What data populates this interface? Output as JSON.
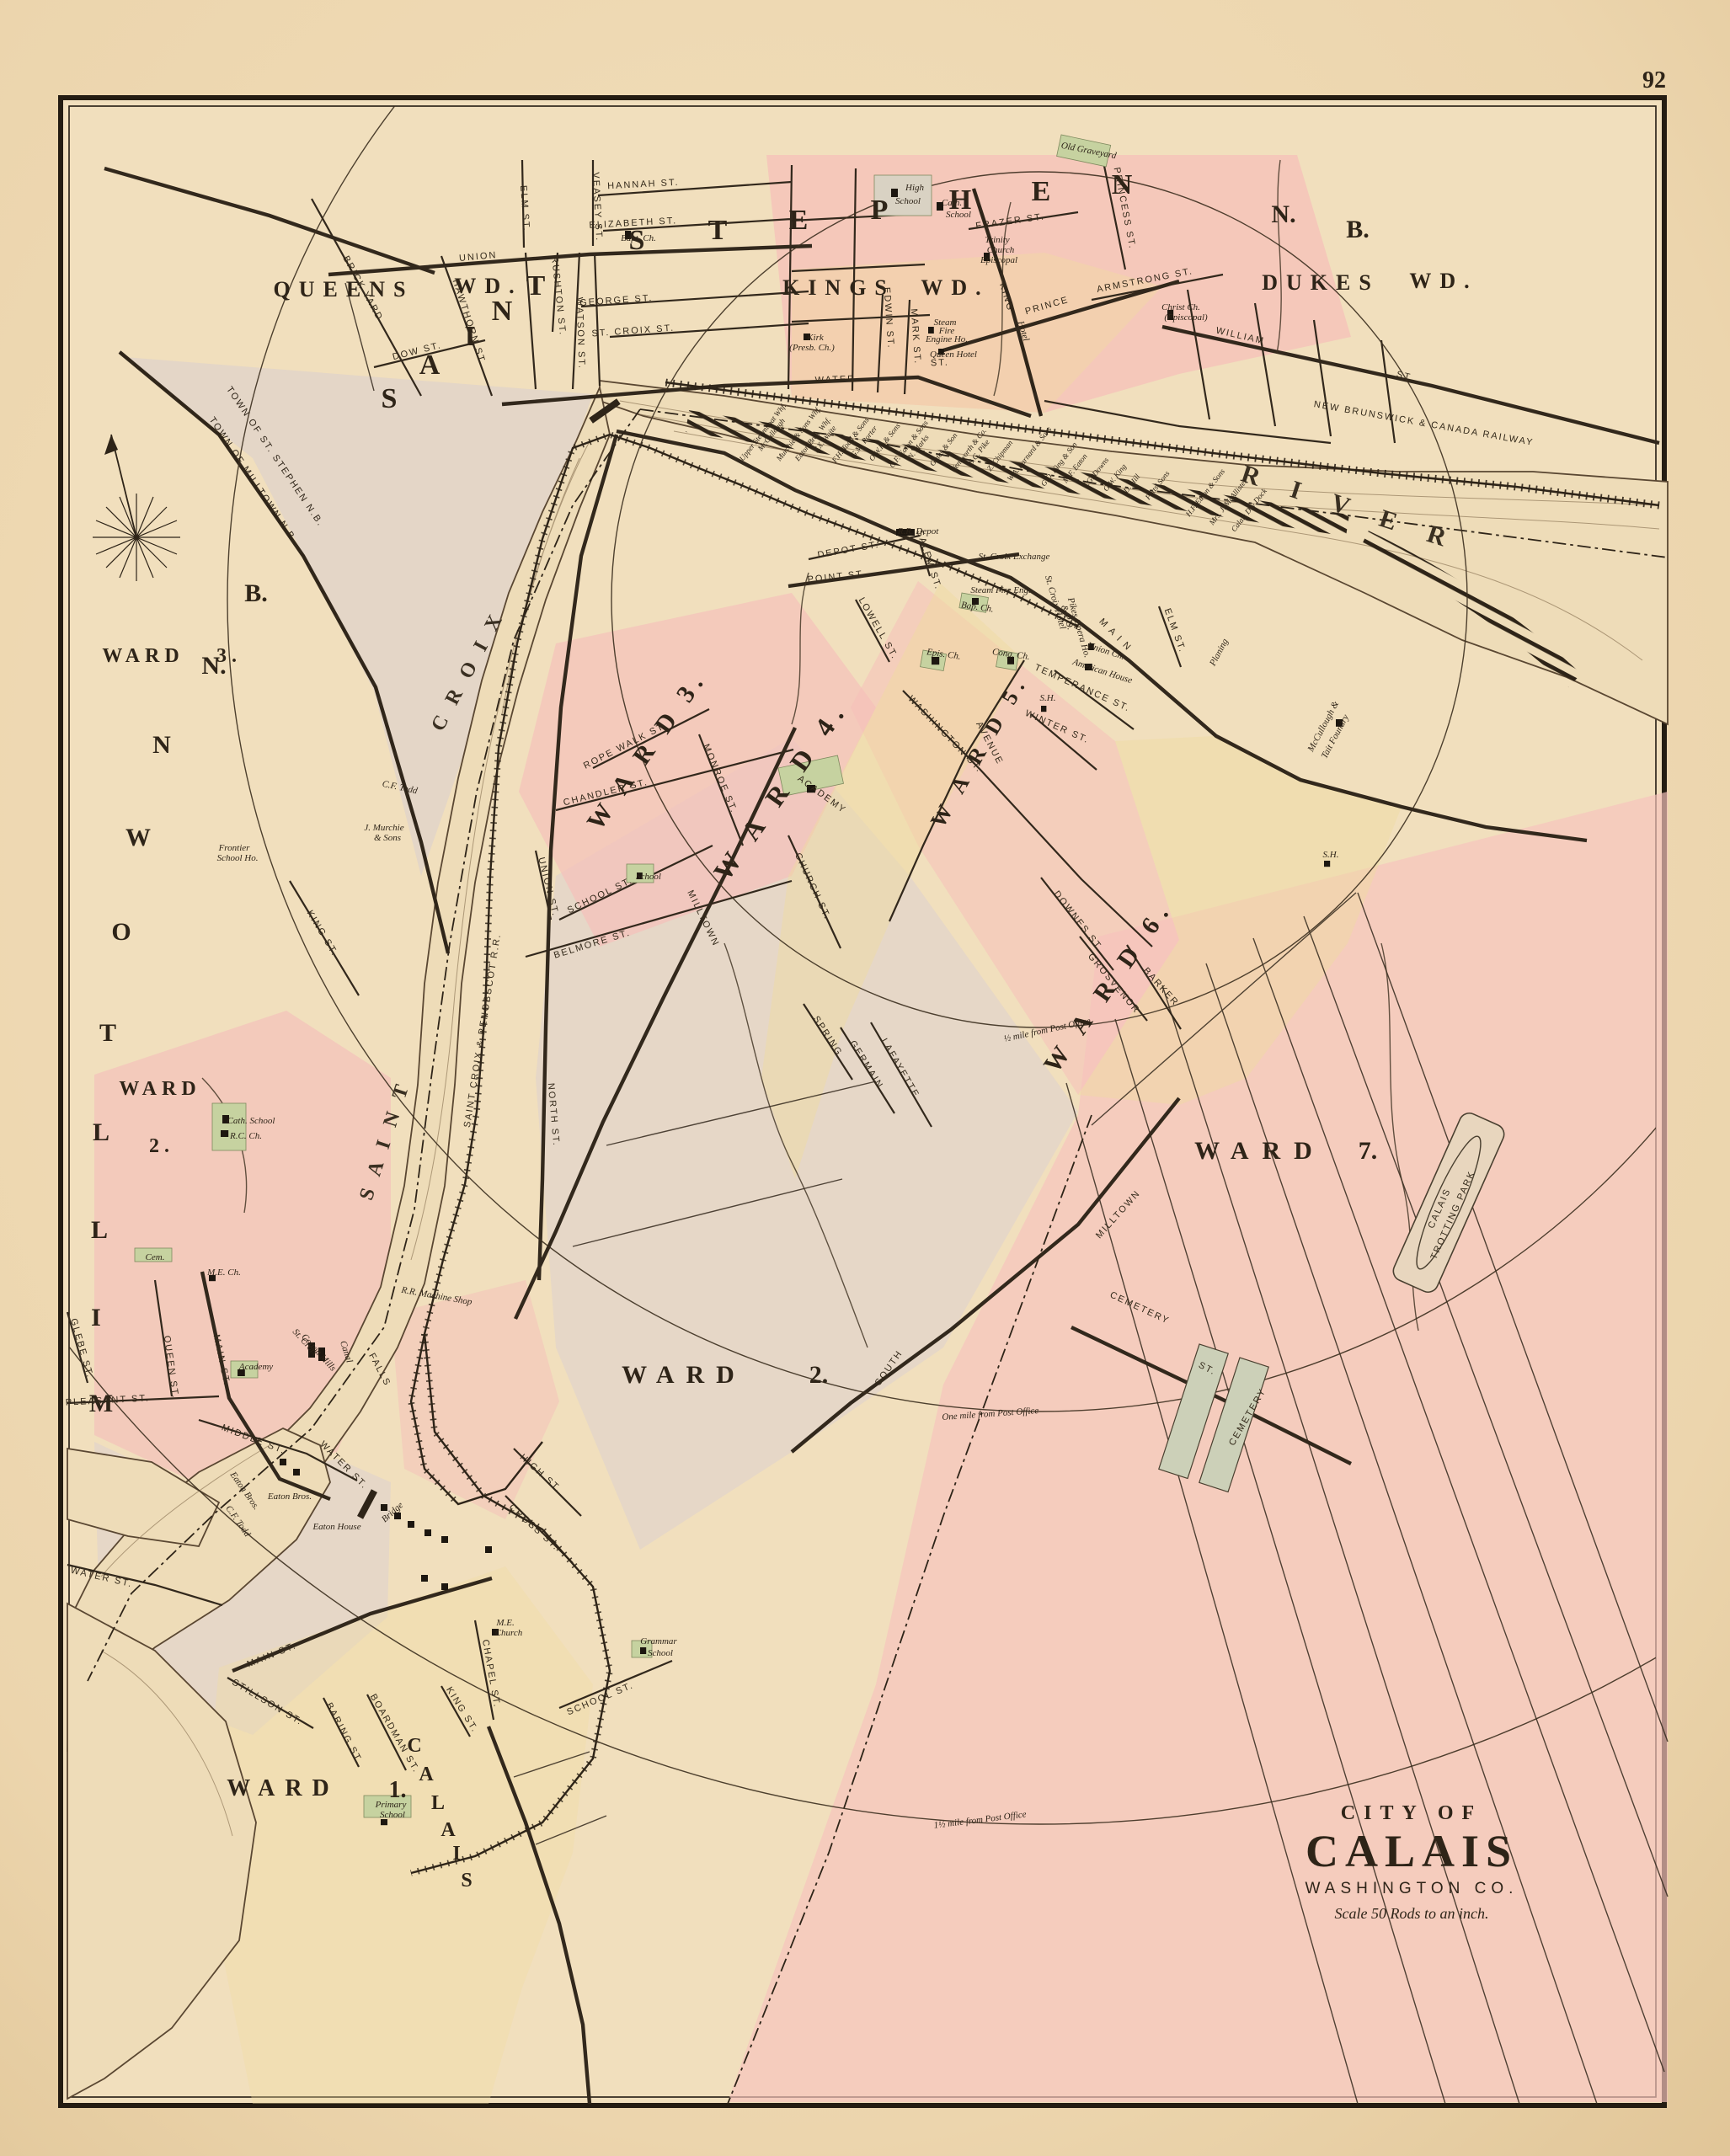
{
  "page_number": "92",
  "title_block": {
    "line1": "CITY OF",
    "line2": "CALAIS",
    "line3": "WASHINGTON CO.",
    "line4": "Scale 50 Rods to an inch."
  },
  "boundary_labels": {
    "st_stephen_side": "TOWN OF ST. STEPHEN N.B.",
    "milltown_side": "TOWN OF MILLTOWN N.B."
  },
  "distance_arcs": {
    "half_mile": "½ mile from Post Office",
    "one_mile": "One mile from Post Office",
    "one_half_mile": "1½ mile from Post Office"
  },
  "railways": {
    "nb_canada": "NEW BRUNSWICK & CANADA RAILWAY",
    "sc_penobscot": "SAINT CROIX & PENOBSCOT R.R."
  },
  "river": {
    "saint": "S A I N T",
    "croix": "C R O I X",
    "river": "R I V E R",
    "falls": "FALLS",
    "canal": "Canal",
    "bridge": "Bridge"
  },
  "nb_wards": {
    "queens": "QUEENS",
    "queens_wd": "WD.",
    "kings": "KINGS",
    "kings_wd": "WD.",
    "dukes": "DUKES",
    "dukes_wd": "WD.",
    "nb_n": "N.",
    "nb_b": "B.",
    "ward3": "WARD",
    "ward3_num": "3.",
    "ward2": "WARD",
    "ward2_num": "2."
  },
  "big_letters": {
    "saint": [
      "S",
      "A",
      "I",
      "N",
      "T"
    ],
    "stephen": [
      "S",
      "T",
      "E",
      "P",
      "H",
      "E",
      "N"
    ],
    "milltown_vertical": [
      "B.",
      "N.",
      "N",
      "W",
      "O",
      "T",
      "L",
      "L",
      "I",
      "M"
    ],
    "calais_vertical": [
      "C",
      "A",
      "L",
      "A",
      "I",
      "S"
    ]
  },
  "calais_wards": {
    "ward1": "WARD",
    "ward1_num": "1.",
    "ward2": "WARD",
    "ward2_num": "2.",
    "ward3": "W A R D  3.",
    "ward4": "W A R D  4.",
    "ward5": "W A R D  5.",
    "ward6": "W A R D  6.",
    "ward7": "WARD",
    "ward7_num": "7."
  },
  "st_stephen_streets": {
    "union": "UNION",
    "hannah": "HANNAH ST.",
    "elizabeth": "ELIZABETH ST.",
    "george": "GEORGE ST.",
    "st_croix": "ST. CROIX ST.",
    "elm": "ELM ST.",
    "veasey": "VEASEY ST.",
    "watson": "WATSON ST.",
    "rushton": "RUSHTON ST.",
    "hawthorn": "HAWTHORN ST.",
    "brick_yard": "BRICK YARD",
    "dow": "DOW ST.",
    "water": "WATER",
    "water_st": "ST.",
    "king": "KING",
    "frazer": "FRAZER ST.",
    "prince": "PRINCE",
    "william": "WILLIAM",
    "william_st": "ST.",
    "princess": "PRINCESS ST.",
    "armstrong": "ARMSTRONG ST.",
    "edwin": "EDWIN ST.",
    "mark": "MARK ST."
  },
  "st_stephen_places": {
    "bapt_ch": "Bapt. Ch.",
    "high_school_1": "High",
    "high_school_2": "School",
    "cath_school_1": "Cath.",
    "cath_school_2": "School",
    "trinity_1": "Trinity",
    "trinity_2": "Church",
    "trinity_3": "Episcopal",
    "old_graveyard": "Old Graveyard",
    "christ_ch_1": "Christ Ch.",
    "christ_ch_2": "(Episcopal)",
    "kirk_1": "Kirk",
    "kirk_2": "(Presb. Ch.)",
    "steam_fire_1": "Steam",
    "steam_fire_2": "Fire",
    "steam_fire_3": "Engine Ho.",
    "queen_hotel": "Queen Hotel",
    "hotel": "Hotel"
  },
  "calais_streets": {
    "main": "M A I N",
    "north": "NORTH ST.",
    "point": "POINT ST.",
    "depot": "DEPOT ST.",
    "salem": "SALEM ST.",
    "lowell": "LOWELL ST.",
    "monroe": "MONROE ST.",
    "washington": "WASHINGTON ST.",
    "avenue": "AVENUE",
    "temperance": "TEMPERANCE ST.",
    "winter": "WINTER ST.",
    "elm": "ELM ST.",
    "church": "CHURCH ST.",
    "spring": "SPRING",
    "germain": "GERMAIN",
    "lafayette": "LAFAYETTE",
    "milltown_ave": "MILLTOWN",
    "union": "UNION ST.",
    "school": "SCHOOL ST.",
    "belmore": "BELMORE ST.",
    "chandler": "CHANDLER ST.",
    "rope_walk": "ROPE WALK ST.",
    "king": "KING ST.",
    "downes": "DOWNES ST.",
    "grosvenor": "GROSVENOR",
    "barker": "BARKER",
    "cemetery_st": "CEMETERY",
    "cemetery_st2": "ST.",
    "south": "SOUTH",
    "milltown_rd": "MILLTOWN",
    "high": "HIGH ST.",
    "cross": "CROSS ST."
  },
  "calais_places": {
    "rr_depot": "R.R. Depot",
    "exchange": "St. Croix Exchange",
    "steam_fire": "Steam Fire Eng.",
    "bap_ch": "Bap. Ch.",
    "epis_ch": "Epis. Ch.",
    "cong_ch": "Cong. Ch.",
    "hotel_po_1": "St. Croix Hotel",
    "hotel_po_2": "& P.O.",
    "opera": "Pikes Opera Ho.",
    "union_ch": "Union Ch.",
    "american_house": "American House",
    "sh1": "S.H.",
    "sh2": "S.H.",
    "academy": "ACADEMY",
    "school_w2": "School",
    "foundry_1": "McCullough &",
    "foundry_2": "Tait Foundry",
    "planing": "Planing",
    "cemetery_block": "CEMETERY",
    "trotting_1": "CALAIS",
    "trotting_2": "TROTTING PARK",
    "cf_todd": "C.F. Todd",
    "murchie_1": "J. Murchie",
    "murchie_2": "& Sons",
    "frontier_1": "Frontier",
    "frontier_2": "School Ho.",
    "grammar_1": "Grammar",
    "grammar_2": "School",
    "me_church_1": "M.E.",
    "me_church_2": "Church",
    "primary_1": "Primary",
    "primary_2": "School"
  },
  "milltown_streets": {
    "main": "MAIN ST.",
    "queen": "QUEEN ST.",
    "glebe": "GLEBE ST.",
    "pleasant": "PLEASANT ST.",
    "middle": "MIDDLE ST.",
    "water": "WATER ST.",
    "water_me": "WATER ST.",
    "main_me": "MAIN ST.",
    "stillson": "STILLSON ST.",
    "baring": "BARING ST.",
    "boardman": "BOARDMAN ST.",
    "king_w1": "KING ST.",
    "chapel": "CHAPEL ST.",
    "school_w1": "SCHOOL ST."
  },
  "milltown_places": {
    "cath_1": "Cath. School",
    "cath_2": "R.C. Ch.",
    "cem": "Cem.",
    "me_ch": "M.E. Ch.",
    "academy": "Academy",
    "cotton_1": "St. Croix",
    "cotton_2": "Cotton Mills",
    "machine_shop": "R.R. Machine Shop",
    "eaton_bros_1": "Eaton Bros.",
    "eaton_bros_2": "Eaton Bros.",
    "cf_todd": "C.F. Todd",
    "eaton_house": "Eaton House"
  },
  "wharves": [
    "Upper Steamboat Whf.",
    "McCullough",
    "Murchie & Sons Whf.",
    "Eaton Bros. Whf.",
    "F.X. Waite",
    "F.H. Todd & Sons",
    "G.M. Porter",
    "O.W.P. & Sons",
    "C.F. Eaton & Sons",
    "N. Marks",
    "Gates & Son",
    "Wentworth & Co.",
    "S.G. Pike",
    "Z. Chipman",
    "W.A. Barnard & Sons",
    "G.D. King & Son",
    "M.F. Eaton",
    "J.G. Downs",
    "G.W. King",
    "D. Hill",
    "Potts' Sons",
    "H.F. Eaton & Sons",
    "Mrs. J. McAllister",
    "Calais Dry Dock"
  ]
}
